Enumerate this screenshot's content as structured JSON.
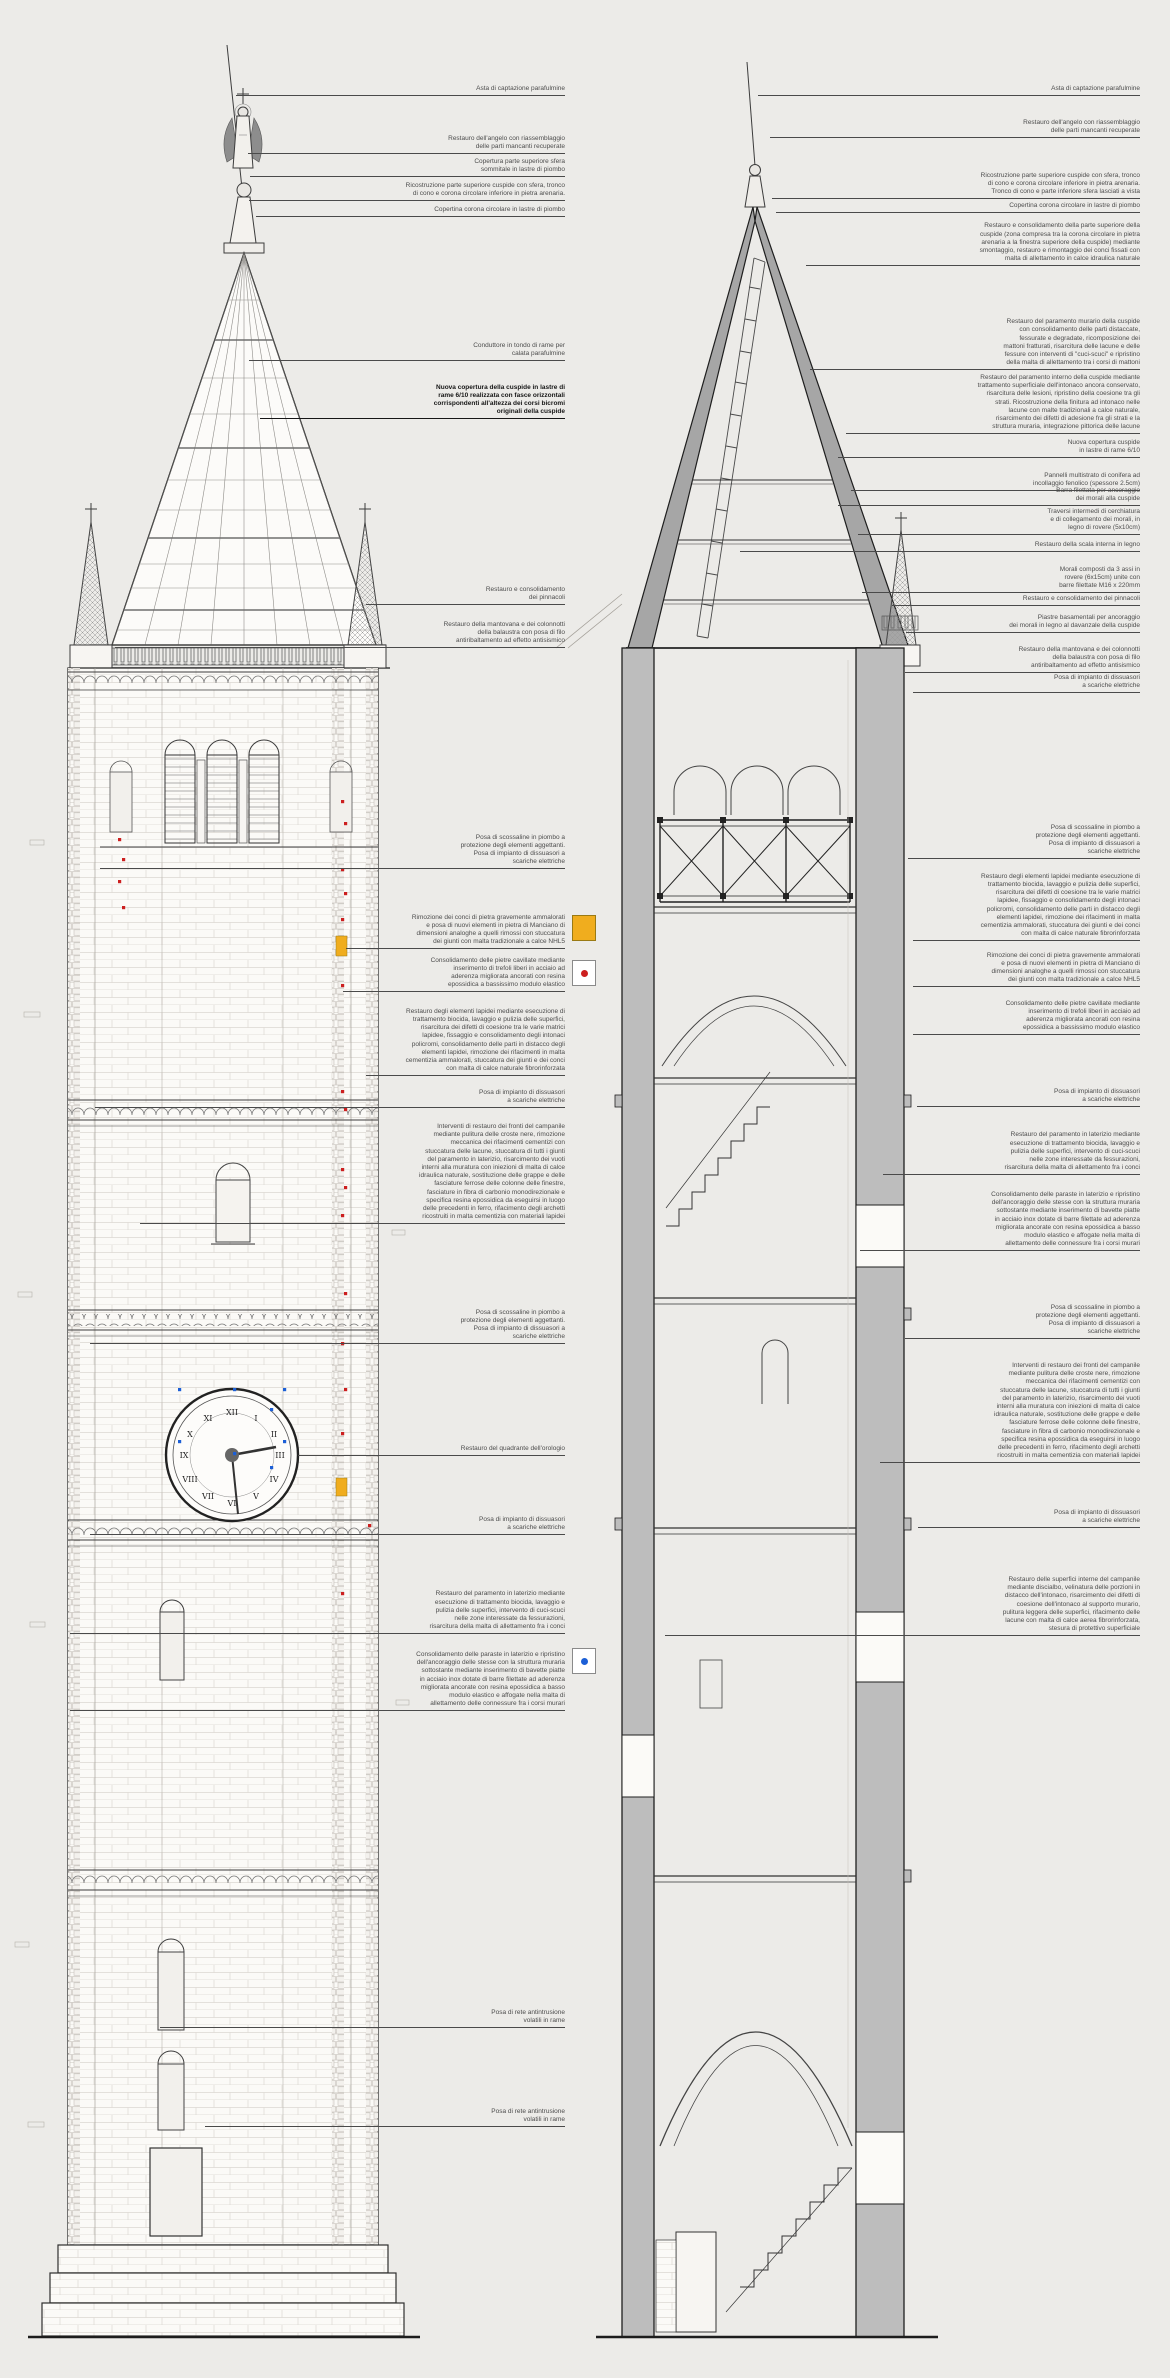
{
  "page": {
    "background_color": "#ecebe8",
    "drawing_line_color": "#3c3c3c",
    "wall_poche_color": "#bdbdbd"
  },
  "legend": {
    "stone_replacement_color": "#f0ad1e",
    "cracked_stone_dot_color": "#cc1f1f",
    "paraste_dot_color": "#1c5fd6"
  },
  "annotations": {
    "left": [
      {
        "text": "Asta di captazione parafulmine"
      },
      {
        "text": "Restauro dell'angelo con riassemblaggio\ndelle parti mancanti recuperate"
      },
      {
        "text": "Copertura parte superiore sfera\nsommitale in lastre di piombo"
      },
      {
        "text": "Ricostruzione parte superiore cuspide con sfera, tronco\ndi cono e corona circolare inferiore in pietra arenaria."
      },
      {
        "text": "Copertina corona circolare in lastre di piombo"
      },
      {
        "text": "Conduttore in tondo di rame per\ncalata parafulmine"
      },
      {
        "text": "Nuova copertura della cuspide in lastre di\nrame 6/10 realizzata con fasce orizzontali\ncorrispondenti all'altezza dei corsi bicromi\noriginali della cuspide"
      },
      {
        "text": "Restauro e consolidamento\ndei pinnacoli"
      },
      {
        "text": "Restauro della mantovana e dei colonnotti\ndella balaustra con posa di filo\nantiribaltamento ad effetto antisismico"
      },
      {
        "text": "Posa di scossaline in piombo a\nprotezione degli elementi aggettanti.\nPosa di impianto di dissuasori a\nscariche elettriche"
      },
      {
        "text": "Rimozione dei conci di pietra gravemente ammalorati\ne posa di nuovi elementi in pietra di Manciano di\ndimensioni analoghe a quelli rimossi con stuccatura\ndei giunti con malta tradizionale a calce NHL5"
      },
      {
        "text": "Consolidamento delle pietre cavillate mediante\ninserimento di trefoli liberi in acciaio ad\naderenza migliorata ancorati con resina\nepossidica a bassissimo modulo elastico"
      },
      {
        "text": "Restauro degli elementi lapidei mediante esecuzione di\ntrattamento biocida, lavaggio e pulizia delle superfici,\nrisarcitura dei difetti di coesione tra le varie matrici\nlapidee, fissaggio e consolidamento degli intonaci\npolicromi, consolidamento delle parti in distacco degli\nelementi lapidei, rimozione dei rifacimenti in malta\ncementizia ammalorati, stuccatura dei giunti e dei conci\ncon malta di calce naturale fibrorinforzata"
      },
      {
        "text": "Posa di impianto di dissuasori\na scariche elettriche"
      },
      {
        "text": "Interventi di restauro dei fronti del campanile\nmediante pulitura delle croste nere, rimozione\nmeccanica dei rifacimenti cementizi con\nstuccatura delle lacune, stuccatura di tutti i giunti\ndel paramento in laterizio, risarcimento dei vuoti\ninterni alla muratura con iniezioni di malta di calce\nidraulica naturale, sostituzione delle grappe e delle\nfasciature ferrose delle colonne delle finestre,\nfasciature in fibra di carbonio monodirezionale e\nspecifica resina epossidica da eseguirsi in luogo\ndelle precedenti in ferro, rifacimento degli archetti\nricostruiti in malta cementizia con materiali lapidei"
      },
      {
        "text": "Posa di scossaline in piombo a\nprotezione degli elementi aggettanti.\nPosa di impianto di dissuasori a\nscariche elettriche"
      },
      {
        "text": "Restauro del quadrante dell'orologio"
      },
      {
        "text": "Posa di impianto di dissuasori\na scariche elettriche"
      },
      {
        "text": "Restauro del paramento in laterizio mediante\nesecuzione di trattamento biocida, lavaggio e\npulizia delle superfici, intervento di cuci-scuci\nnelle zone interessate da fessurazioni,\nrisarcitura della malta di allettamento fra i conci"
      },
      {
        "text": "Consolidamento delle paraste in laterizio e ripristino\ndell'ancoraggio delle stesse con la struttura muraria\nsottostante mediante inserimento di bavette piatte\nin acciaio inox dotate di barre filettate ad aderenza\nmigliorata ancorate con resina epossidica a basso\nmodulo elastico e affogate nella malta di\nallettamento delle connessure fra i corsi murari"
      },
      {
        "text": "Posa di rete antintrusione\nvolatili in rame"
      },
      {
        "text": "Posa di rete antintrusione\nvolatili in rame"
      }
    ],
    "right": [
      {
        "text": "Asta di captazione parafulmine"
      },
      {
        "text": "Restauro dell'angelo con riassemblaggio\ndelle parti mancanti recuperate"
      },
      {
        "text": "Ricostruzione parte superiore cuspide con sfera, tronco\ndi cono e corona circolare inferiore in pietra arenaria.\nTronco di cono e parte inferiore sfera lasciati a vista"
      },
      {
        "text": "Copertina corona circolare in lastre di piombo"
      },
      {
        "text": "Restauro e consolidamento della parte superiore della\ncuspide (zona compresa tra la corona circolare in pietra\narenaria a la finestra superiore della cuspide) mediante\nsmontaggio, restauro e rimontaggio dei conci fissati con\nmalta di allettamento in calce idraulica naturale"
      },
      {
        "text": "Restauro del paramento murario della cuspide\ncon consolidamento delle parti distaccate,\nfessurate e degradate, ricomposizione dei\nmattoni fratturati, risarcitura delle lacune e delle\nfessure con interventi di \"cuci-scuci\" e ripristino\ndella malta di allettamento tra i corsi di mattoni"
      },
      {
        "text": "Restauro del paramento interno della cuspide mediante\ntrattamento superficiale dell'intonaco ancora conservato,\nrisarcitura delle lesioni, ripristino della coesione tra gli\nstrati. Ricostruzione della finitura ad intonaco nelle\nlacune con malte tradizionali a calce naturale,\nrisarcimento dei difetti di adesione fra gli strati e la\nstruttura muraria, integrazione pittorica delle lacune"
      },
      {
        "text": "Nuova copertura cuspide\nin lastre di rame 6/10"
      },
      {
        "text": "Pannelli multistrato di conifera ad\nincollaggio fenolico (spessore 2.5cm)"
      },
      {
        "text": "Barra filettata per ancoraggio\ndei morali alla cuspide"
      },
      {
        "text": "Traversi intermedi di cerchiatura\ne di collegamento dei morali, in\nlegno di rovere (5x10cm)"
      },
      {
        "text": "Restauro della scala interna in legno"
      },
      {
        "text": "Morali composti da 3 assi in\nrovere (6x15cm) unite con\nbarre filettate M16 x 220mm"
      },
      {
        "text": "Restauro e consolidamento dei pinnacoli"
      },
      {
        "text": "Piastre basamentali per ancoraggio\ndei morali in legno al davanzale della cuspide"
      },
      {
        "text": "Restauro della mantovana e dei colonnotti\ndella balaustra con posa di filo\nantiribaltamento ad effetto antisismico"
      },
      {
        "text": "Posa di impianto di dissuasori\na scariche elettriche"
      },
      {
        "text": "Posa di scossaline in piombo a\nprotezione degli elementi aggettanti.\nPosa di impianto di dissuasori a\nscariche elettriche"
      },
      {
        "text": "Restauro degli elementi lapidei mediante esecuzione di\ntrattamento biocida, lavaggio e pulizia delle superfici,\nrisarcitura dei difetti di coesione tra le varie matrici\nlapidee, fissaggio e consolidamento degli intonaci\npolicromi, consolidamento delle parti in distacco degli\nelementi lapidei, rimozione dei rifacimenti in malta\ncementizia ammalorati, stuccatura dei giunti e dei conci\ncon malta di calce naturale fibrorinforzata"
      },
      {
        "text": "Rimozione dei conci di pietra gravemente ammalorati\ne posa di nuovi elementi in pietra di Manciano di\ndimensioni analoghe a quelli rimossi con stuccatura\ndei giunti con malta tradizionale a calce NHL5"
      },
      {
        "text": "Consolidamento delle pietre cavillate mediante\ninserimento di trefoli liberi in acciaio ad\naderenza migliorata ancorati con resina\nepossidica a bassissimo modulo elastico"
      },
      {
        "text": "Posa di impianto di dissuasori\na scariche elettriche"
      },
      {
        "text": "Restauro del paramento in laterizio mediante\nesecuzione di trattamento biocida, lavaggio e\npulizia delle superfici, intervento di cuci-scuci\nnelle zone interessate da fessurazioni,\nrisarcitura della malta di allettamento fra i conci"
      },
      {
        "text": "Consolidamento delle paraste in laterizio e ripristino\ndell'ancoraggio delle stesse con la struttura muraria\nsottostante mediante inserimento di bavette piatte\nin acciaio inox dotate di barre filettate ad aderenza\nmigliorata ancorate con resina epossidica a basso\nmodulo elastico e affogate nella malta di\nallettamento delle connessure fra i corsi murari"
      },
      {
        "text": "Posa di scossaline in piombo a\nprotezione degli elementi aggettanti.\nPosa di impianto di dissuasori a\nscariche elettriche"
      },
      {
        "text": "Interventi di restauro dei fronti del campanile\nmediante pulitura delle croste nere, rimozione\nmeccanica dei rifacimenti cementizi con\nstuccatura delle lacune, stuccatura di tutti i giunti\ndel paramento in laterizio, risarcimento dei vuoti\ninterni alla muratura con iniezioni di malta di calce\nidraulica naturale, sostituzione delle grappe e delle\nfasciature ferrose delle colonne delle finestre,\nfasciature in fibra di carbonio monodirezionale e\nspecifica resina epossidica da eseguirsi in luogo\ndelle precedenti in ferro, rifacimento degli archetti\nricostruiti in malta cementizia con materiali lapidei"
      },
      {
        "text": "Posa di impianto di dissuasori\na scariche elettriche"
      },
      {
        "text": "Restauro delle superfici interne del campanile\nmediante discialbo, velinatura delle porzioni in\ndistacco dell'intonaco, risarcimento dei difetti di\ncoesione dell'intonaco al supporto murario,\npulitura leggera delle superfici, rifacimento delle\nlacune con malta di calce aerea fibrorinforzata,\nstesura di protettivo superficiale"
      }
    ]
  },
  "clock": {
    "numerals": [
      "XII",
      "I",
      "II",
      "III",
      "IV",
      "V",
      "VI",
      "VII",
      "VIII",
      "IX",
      "X",
      "XI"
    ]
  }
}
